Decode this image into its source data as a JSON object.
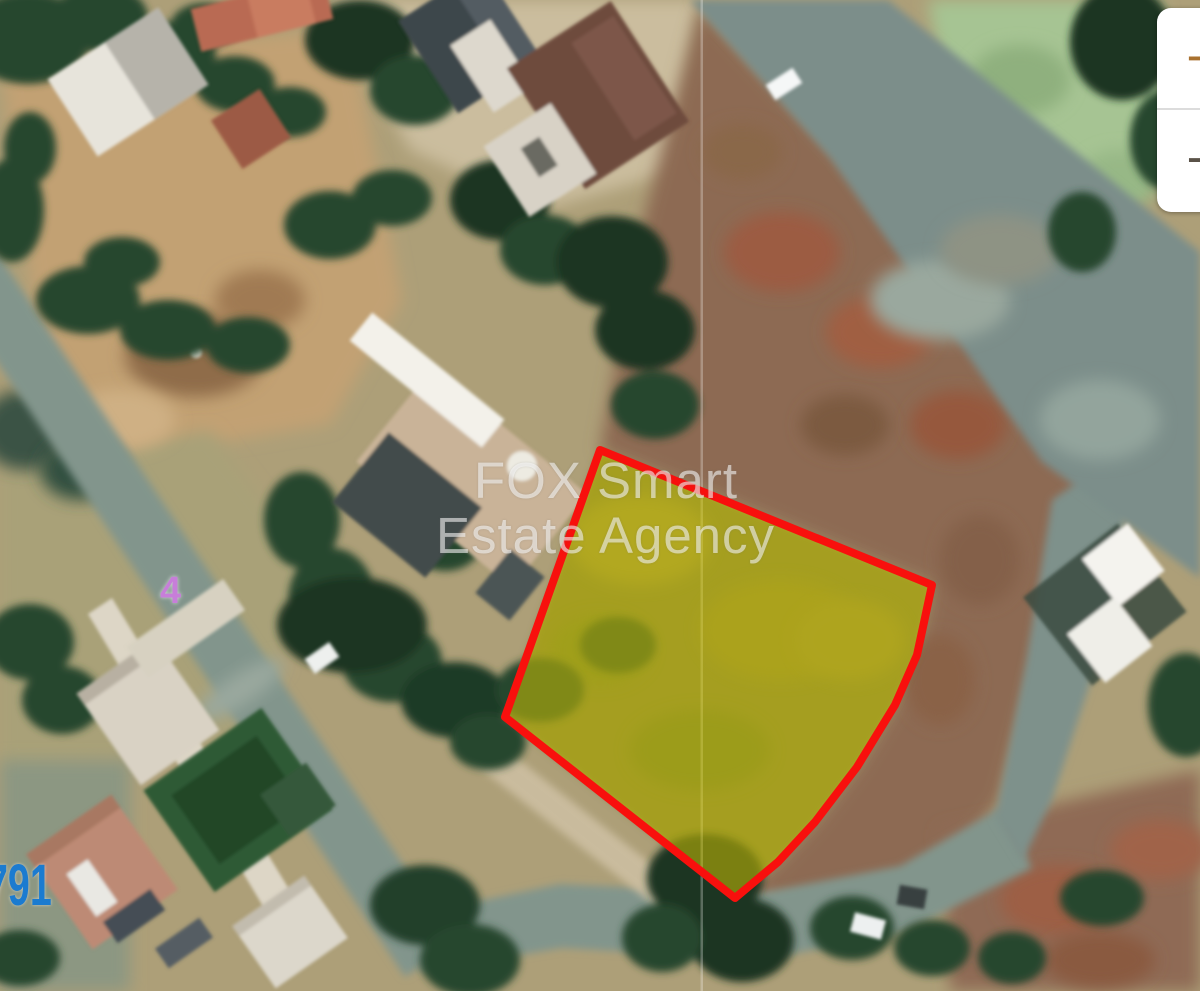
{
  "window": {
    "width_px": 1200,
    "height_px": 991
  },
  "map": {
    "description": "satellite-map-with-parcel-highlight",
    "watermark": {
      "line1": "FOX Smart",
      "line2": "Estate Agency",
      "color": "rgba(255,255,255,0.55)"
    },
    "labels": {
      "road_number": {
        "text": "4",
        "color": "#c77ed9"
      },
      "parcel_number": {
        "text": "791",
        "color": "#1b7bd0"
      }
    },
    "parcel_highlight": {
      "points": "600,450 932,585 917,655 895,705 857,767 815,822 778,862 735,898 505,717",
      "fill": "#d9cc00",
      "fill_opacity": "0.5",
      "stroke": "#f8100d",
      "stroke_width": "8"
    }
  },
  "zoom_control": {
    "zoom_in": {
      "label": "+",
      "color": "#a9712f"
    },
    "zoom_out": {
      "label": "−",
      "color": "#5a5248"
    },
    "background": "#ffffff"
  }
}
